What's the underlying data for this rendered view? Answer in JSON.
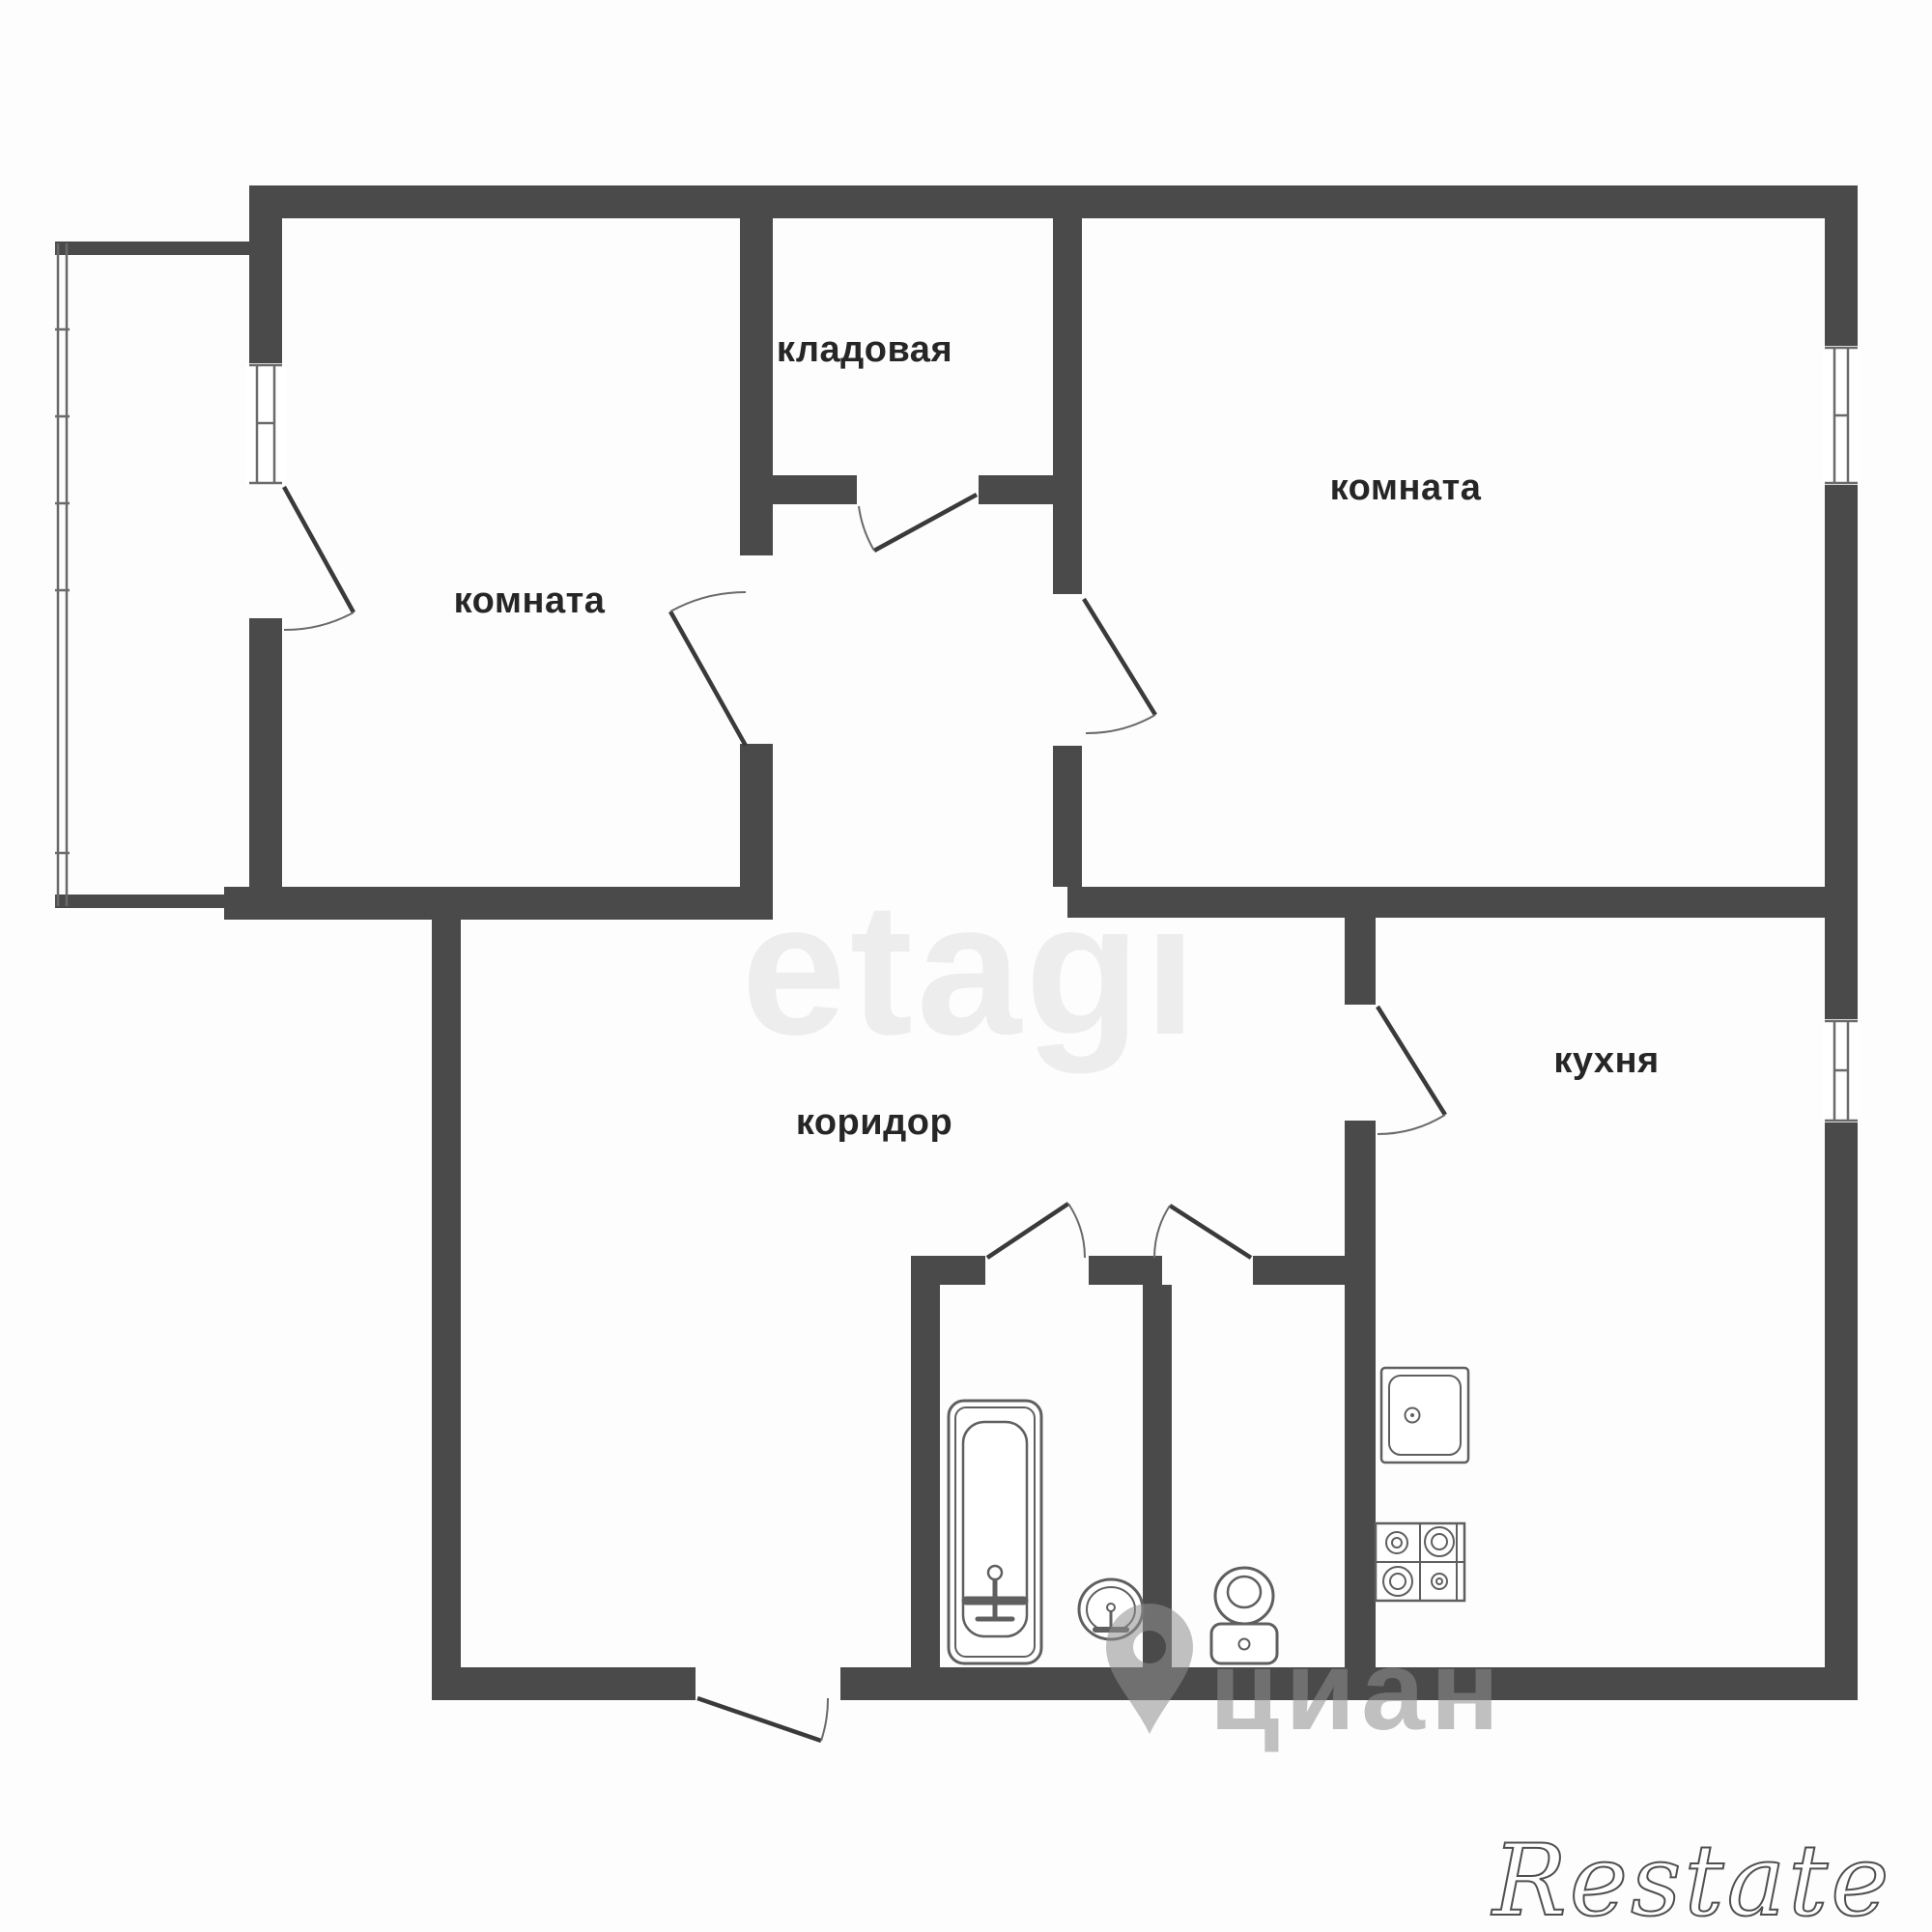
{
  "document": {
    "type": "apartment-floor-plan"
  },
  "rooms": [
    {
      "id": "room-left",
      "label": "комната"
    },
    {
      "id": "storage",
      "label": "кладовая"
    },
    {
      "id": "room-right",
      "label": "комната"
    },
    {
      "id": "corridor",
      "label": "коридор"
    },
    {
      "id": "kitchen",
      "label": "кухня"
    }
  ],
  "watermarks": {
    "brand_center": "etagi",
    "brand_portal": "циан",
    "brand_corner": "Restate"
  },
  "fixtures": {
    "bathtub": "bathtub",
    "bathroom_sink": "oval-sink",
    "toilet": "toilet",
    "kitchen_sink": "kitchen-sink",
    "stove": "stove-4-burner"
  },
  "features": {
    "balcony_glazing": "glazed-balcony-left",
    "windows": [
      "room-left-window",
      "room-right-window",
      "kitchen-window"
    ],
    "doors": [
      "balcony-door",
      "room-left-door",
      "storage-door",
      "room-right-door",
      "kitchen-door",
      "bathroom-door",
      "wc-door",
      "entrance-door"
    ]
  },
  "colors": {
    "wall": "#4a4a4a",
    "label_text": "#262626",
    "fixture_stroke": "#5f5f5f",
    "watermark_light": "#ededed",
    "watermark_gray": "#8f8f8f",
    "background": "#fdfdfd"
  }
}
